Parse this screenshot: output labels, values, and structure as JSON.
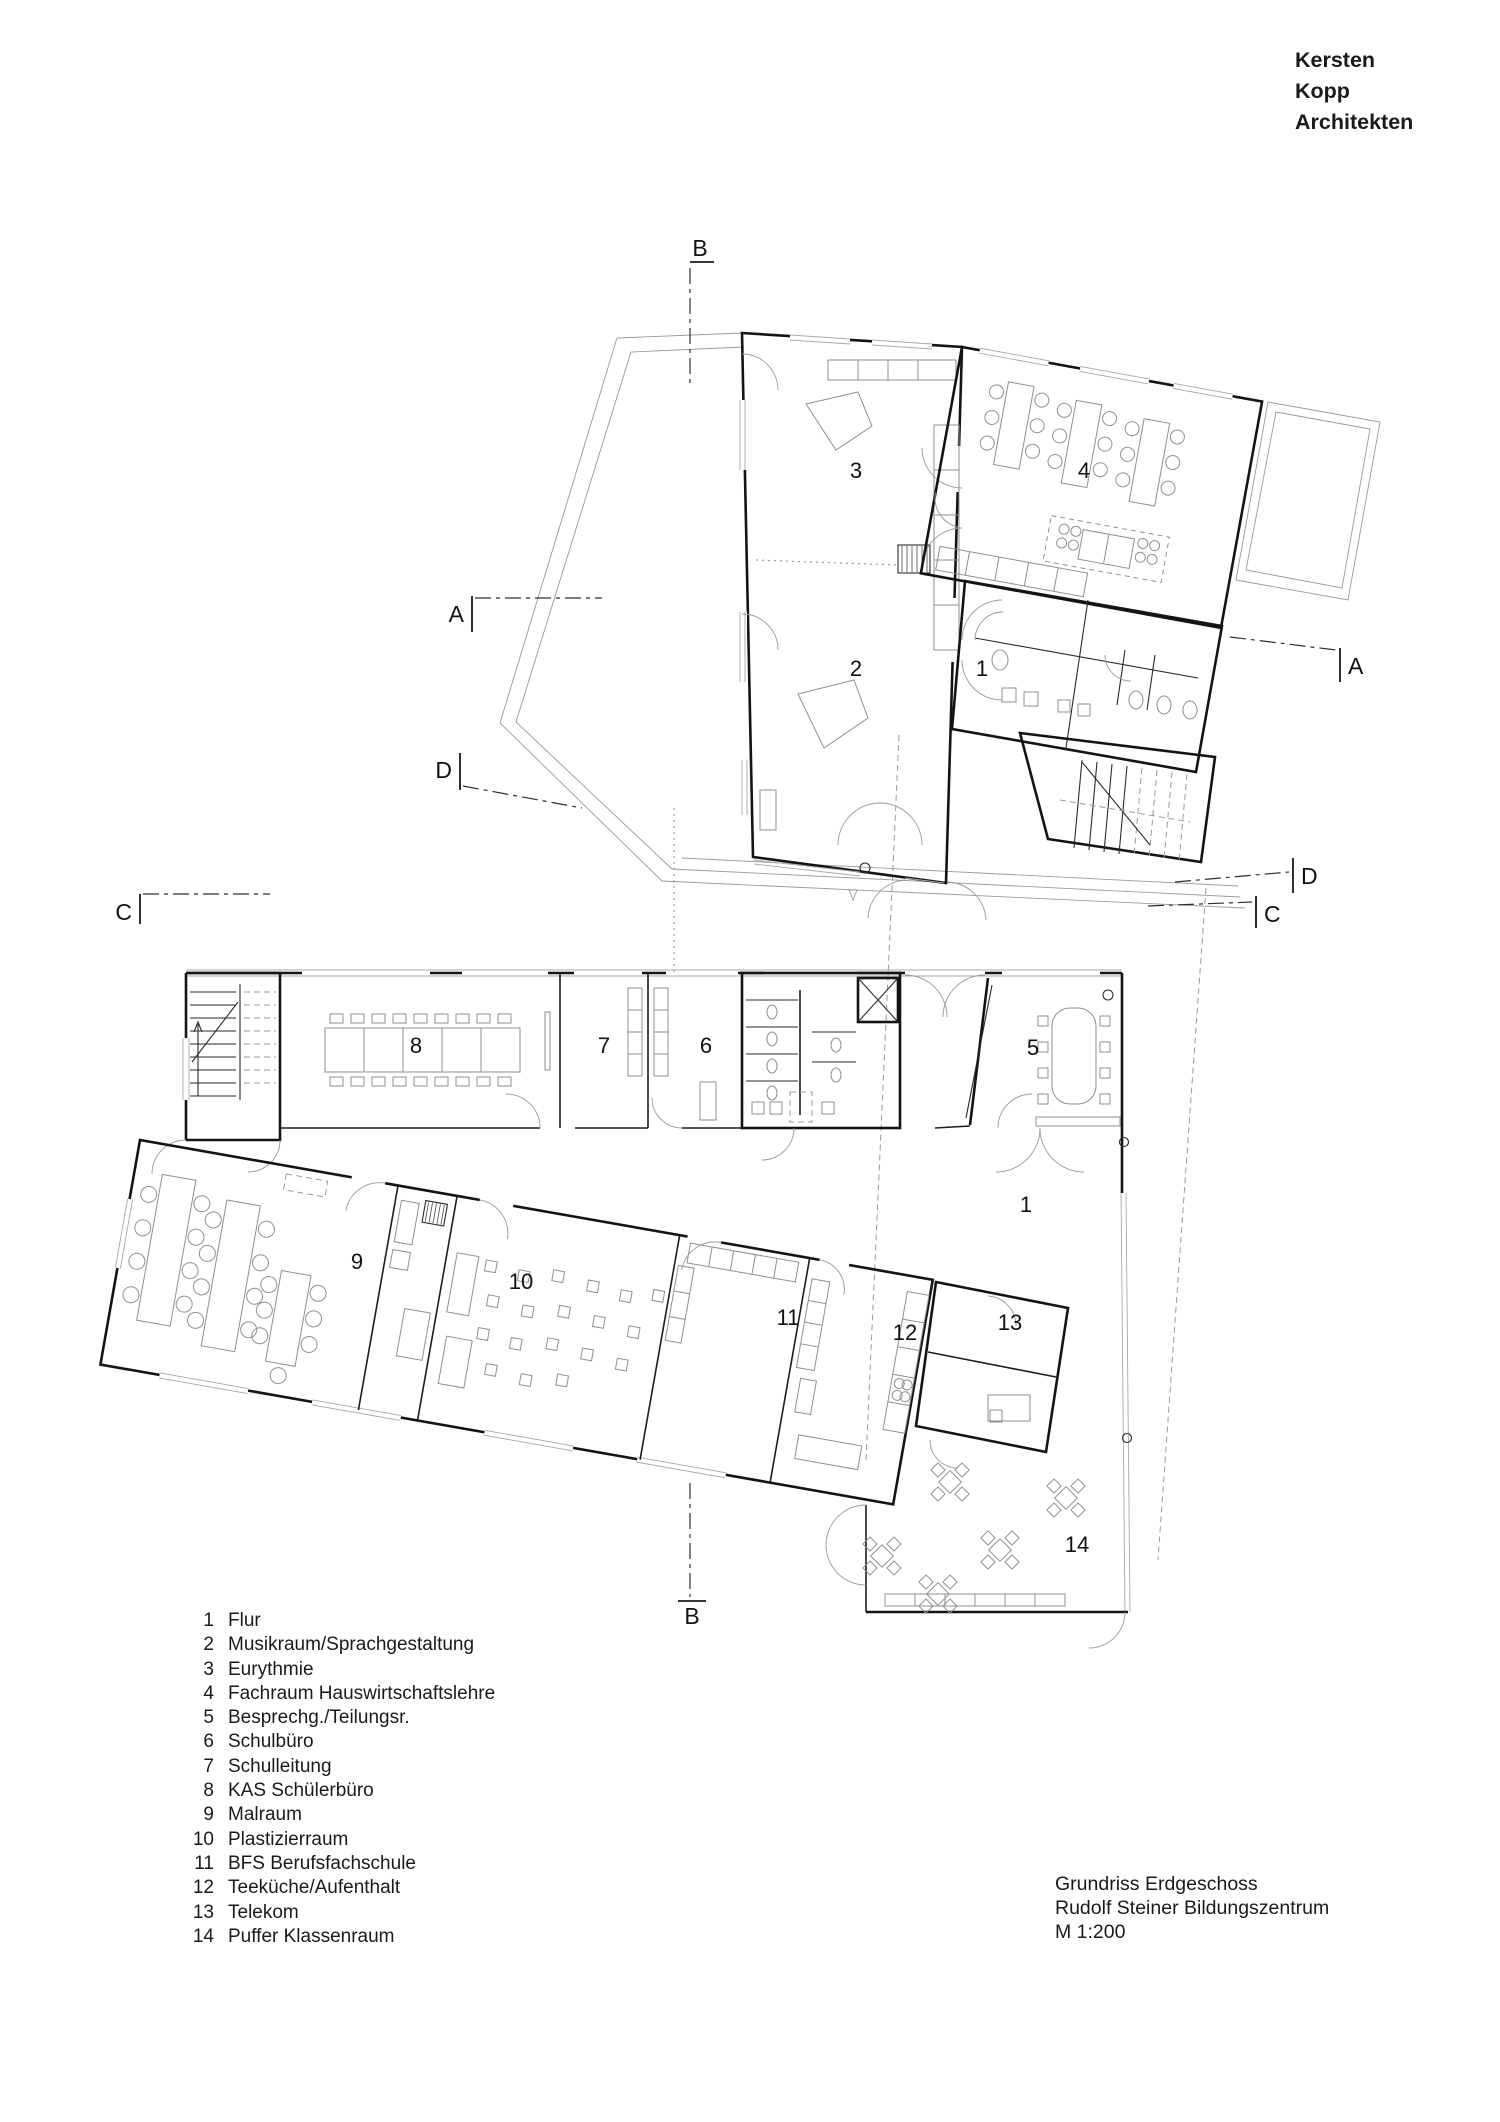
{
  "brand": {
    "line1": "Kersten",
    "line2": "Kopp",
    "line3": "Architekten"
  },
  "title_block": {
    "line1": "Grundriss Erdgeschoss",
    "line2": "Rudolf Steiner Bildungszentrum",
    "line3": "M 1:200"
  },
  "section_markers": {
    "a": "A",
    "b": "B",
    "c": "C",
    "d": "D"
  },
  "legend": {
    "items": [
      {
        "num": "1",
        "label": "Flur"
      },
      {
        "num": "2",
        "label": "Musikraum/Sprachgestaltung"
      },
      {
        "num": "3",
        "label": "Eurythmie"
      },
      {
        "num": "4",
        "label": "Fachraum Hauswirtschaftslehre"
      },
      {
        "num": "5",
        "label": "Besprechg./Teilungsr."
      },
      {
        "num": "6",
        "label": "Schulbüro"
      },
      {
        "num": "7",
        "label": "Schulleitung"
      },
      {
        "num": "8",
        "label": "KAS Schülerbüro"
      },
      {
        "num": "9",
        "label": "Malraum"
      },
      {
        "num": "10",
        "label": "Plastizierraum"
      },
      {
        "num": "11",
        "label": "BFS Berufsfachschule"
      },
      {
        "num": "12",
        "label": "Teeküche/Aufenthalt"
      },
      {
        "num": "13",
        "label": "Telekom"
      },
      {
        "num": "14",
        "label": "Puffer Klassenraum"
      }
    ]
  },
  "plans": {
    "upper": {
      "labels": [
        {
          "num": "3"
        },
        {
          "num": "4"
        },
        {
          "num": "2"
        },
        {
          "num": "1"
        }
      ]
    },
    "lower": {
      "labels": [
        {
          "num": "8"
        },
        {
          "num": "7"
        },
        {
          "num": "6"
        },
        {
          "num": "5"
        },
        {
          "num": "1"
        },
        {
          "num": "9"
        },
        {
          "num": "10"
        },
        {
          "num": "11"
        },
        {
          "num": "12"
        },
        {
          "num": "13"
        },
        {
          "num": "14"
        }
      ]
    }
  },
  "colors": {
    "line": "#141414",
    "furniture": "#8f8f8f",
    "background": "#ffffff"
  }
}
